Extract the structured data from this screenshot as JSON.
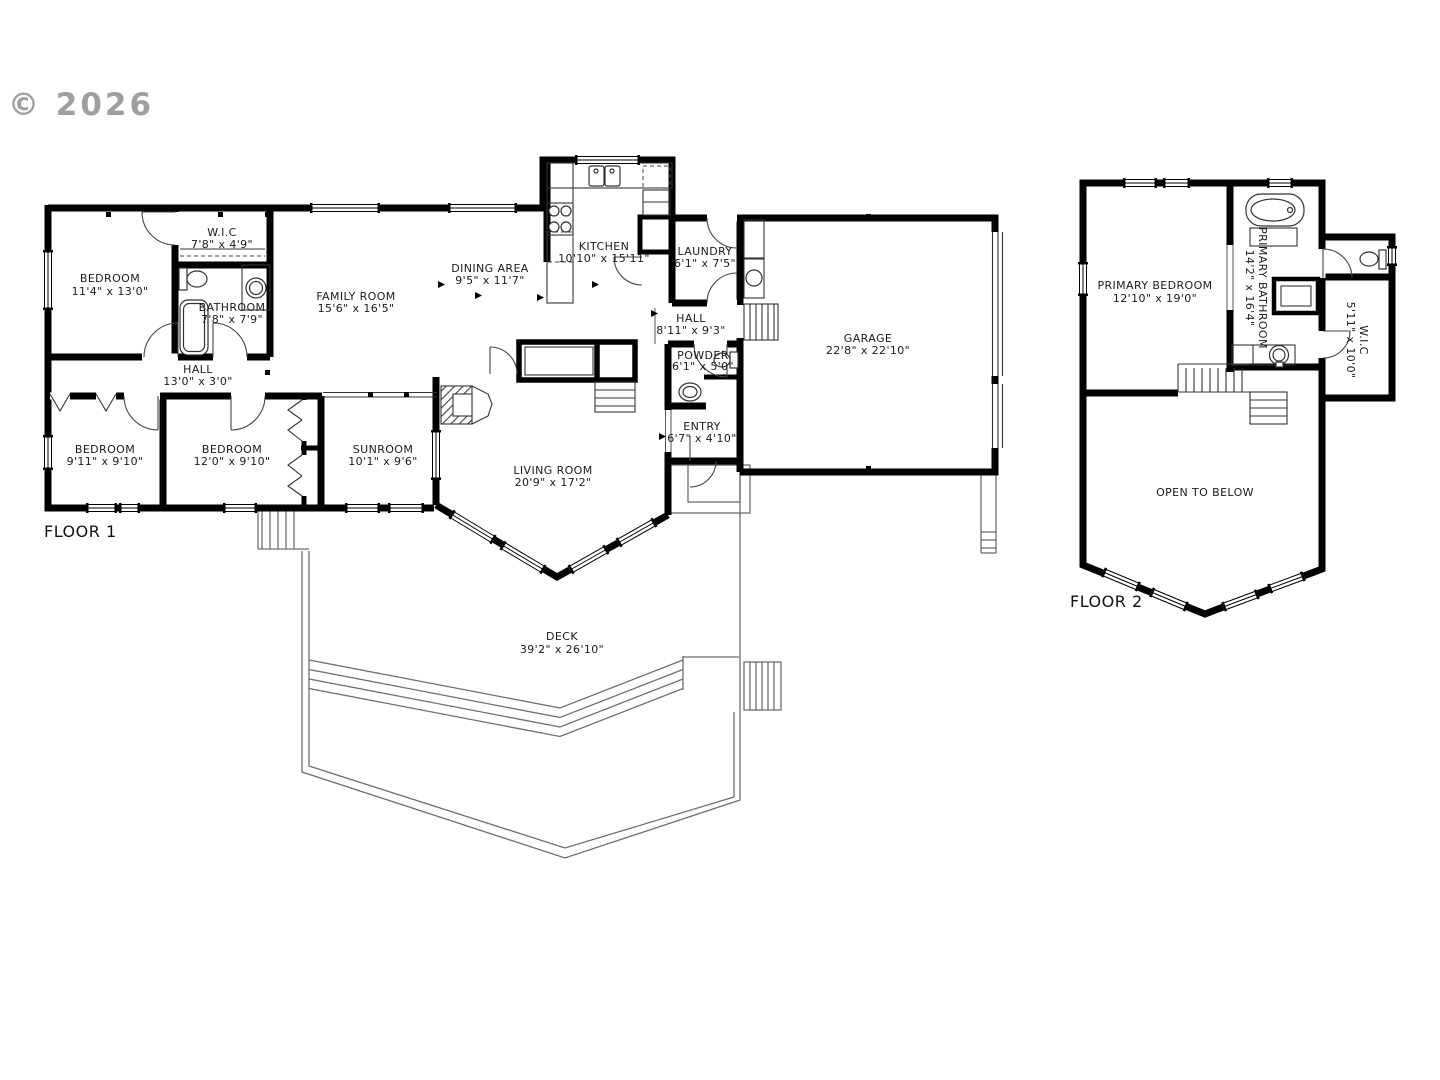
{
  "watermark": "© 2026",
  "floor1": {
    "label": "FLOOR 1",
    "rooms": {
      "bedroom_tl": {
        "name": "BEDROOM",
        "dims": "11'4\" x 13'0\""
      },
      "wic": {
        "name": "W.I.C",
        "dims": "7'8\" x 4'9\""
      },
      "bathroom": {
        "name": "BATHROOM",
        "dims": "7'8\" x 7'9\""
      },
      "family_room": {
        "name": "FAMILY ROOM",
        "dims": "15'6\" x 16'5\""
      },
      "dining_area": {
        "name": "DINING AREA",
        "dims": "9'5\" x 11'7\""
      },
      "kitchen": {
        "name": "KITCHEN",
        "dims": "10'10\" x 15'11\""
      },
      "laundry": {
        "name": "LAUNDRY",
        "dims": "6'1\" x 7'5\""
      },
      "hall_upper": {
        "name": "HALL",
        "dims": "8'11\" x 9'3\""
      },
      "garage": {
        "name": "GARAGE",
        "dims": "22'8\" x 22'10\""
      },
      "hall_lower": {
        "name": "HALL",
        "dims": "13'0\" x 3'0\""
      },
      "powder": {
        "name": "POWDER",
        "dims": "6'1\" x 5'0\""
      },
      "entry": {
        "name": "ENTRY",
        "dims": "6'7\" x 4'10\""
      },
      "bedroom_bl": {
        "name": "BEDROOM",
        "dims": "9'11\" x 9'10\""
      },
      "bedroom_bm": {
        "name": "BEDROOM",
        "dims": "12'0\" x 9'10\""
      },
      "sunroom": {
        "name": "SUNROOM",
        "dims": "10'1\" x 9'6\""
      },
      "living_room": {
        "name": "LIVING ROOM",
        "dims": "20'9\" x 17'2\""
      },
      "deck": {
        "name": "DECK",
        "dims": "39'2\" x 26'10\""
      }
    }
  },
  "floor2": {
    "label": "FLOOR 2",
    "rooms": {
      "primary_bedroom": {
        "name": "PRIMARY BEDROOM",
        "dims": "12'10\" x 19'0\""
      },
      "primary_bathroom": {
        "name": "PRIMARY BATHROOM",
        "dims": "14'2\" x 16'4\""
      },
      "wic": {
        "name": "W.I.C",
        "dims": "5'11\" x 10'0\""
      },
      "open_to_below": {
        "name": "OPEN TO BELOW"
      }
    }
  }
}
